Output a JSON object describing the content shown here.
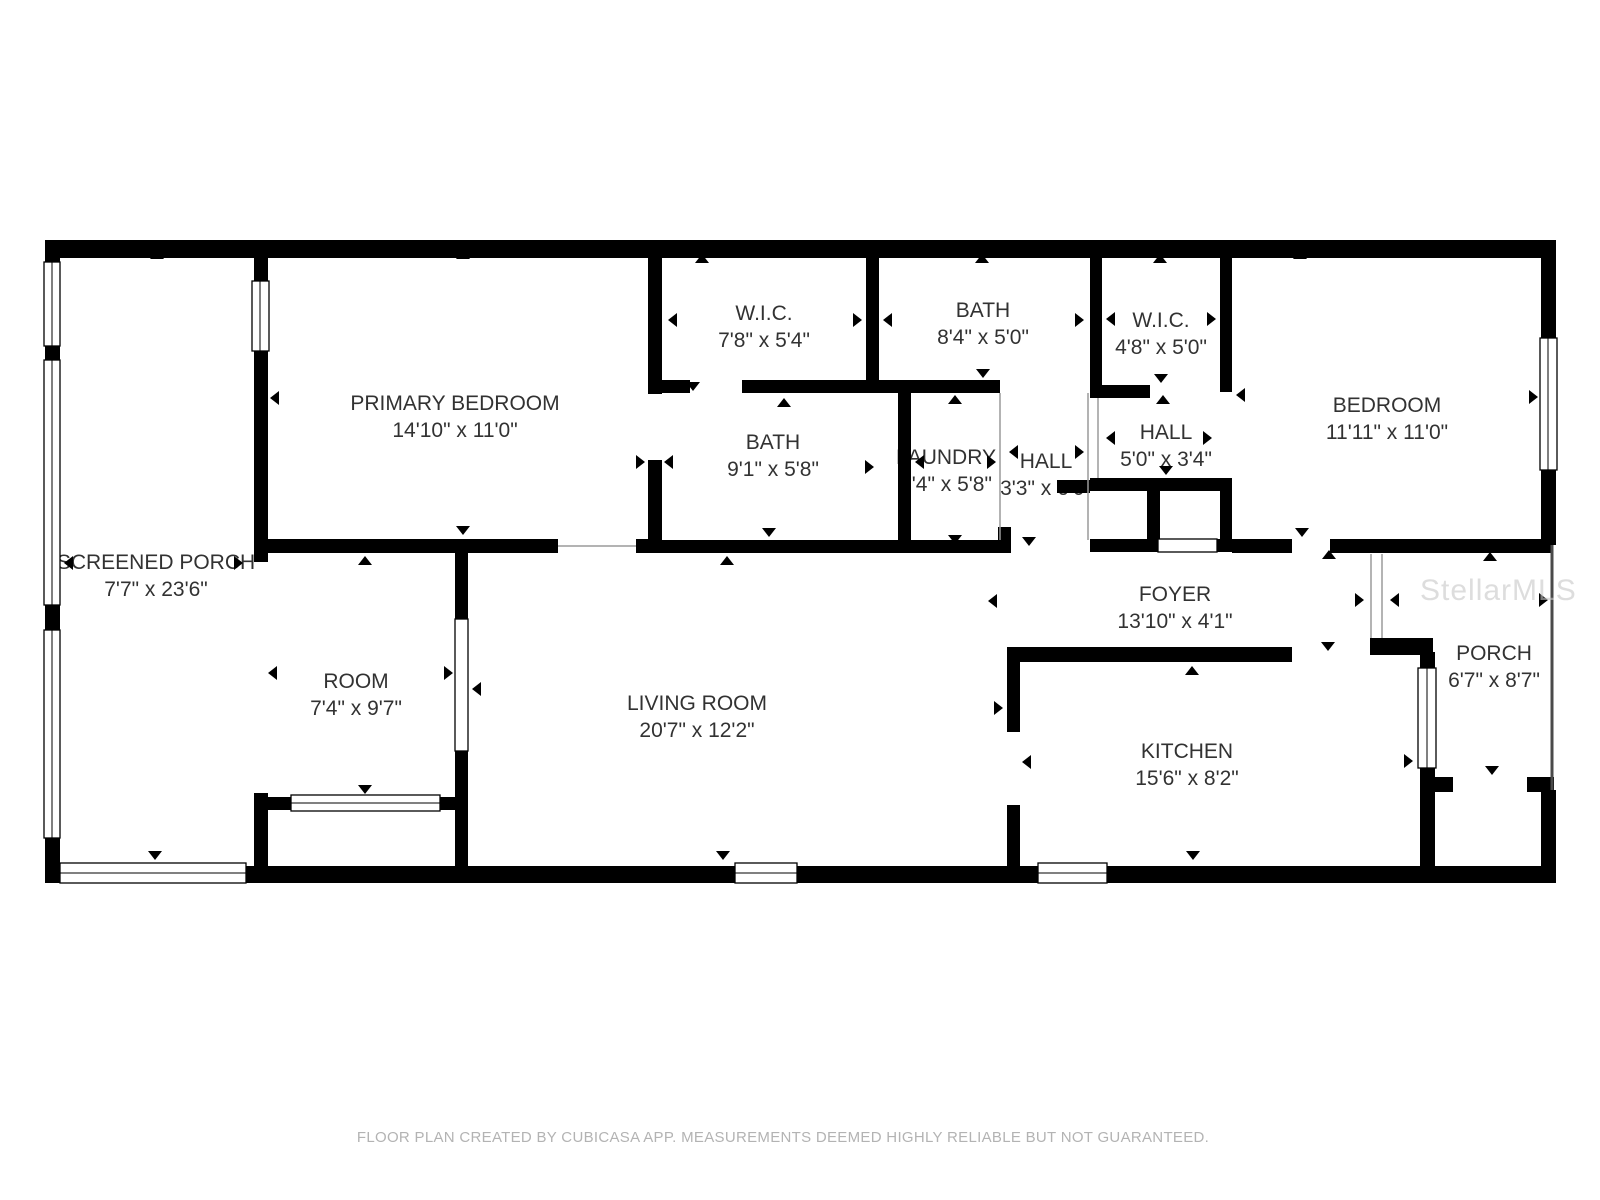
{
  "page": {
    "width": 1600,
    "height": 1200,
    "background": "#ffffff"
  },
  "colors": {
    "wall": "#000000",
    "floor": "#ffffff",
    "label_text": "#323232",
    "footer_text": "#b3b3b3",
    "watermark_text": "#c8c8c8"
  },
  "watermark": {
    "text": "StellarMLS"
  },
  "footer": {
    "text": "FLOOR PLAN CREATED BY CUBICASA APP. MEASUREMENTS DEEMED HIGHLY RELIABLE BUT NOT GUARANTEED."
  },
  "rooms": [
    {
      "name": "SCREENED PORCH",
      "dims": "7'7\" x 23'6\""
    },
    {
      "name": "PRIMARY BEDROOM",
      "dims": "14'10\" x 11'0\""
    },
    {
      "name": "W.I.C.",
      "dims": "7'8\" x 5'4\""
    },
    {
      "name": "BATH",
      "dims": "8'4\" x 5'0\""
    },
    {
      "name": "W.I.C.",
      "dims": "4'8\" x 5'0\""
    },
    {
      "name": "BATH",
      "dims": "9'1\" x 5'8\""
    },
    {
      "name": "LAUNDRY",
      "dims": "3'4\" x 5'8\""
    },
    {
      "name": "HALL",
      "dims": "3'3\" x 6'0\""
    },
    {
      "name": "HALL",
      "dims": "5'0\" x 3'4\""
    },
    {
      "name": "BEDROOM",
      "dims": "11'11\" x 11'0\""
    },
    {
      "name": "ROOM",
      "dims": "7'4\" x 9'7\""
    },
    {
      "name": "LIVING ROOM",
      "dims": "20'7\" x 12'2\""
    },
    {
      "name": "FOYER",
      "dims": "13'10\" x 4'1\""
    },
    {
      "name": "KITCHEN",
      "dims": "15'6\" x 8'2\""
    },
    {
      "name": "PORCH",
      "dims": "6'7\" x 8'7\""
    }
  ]
}
